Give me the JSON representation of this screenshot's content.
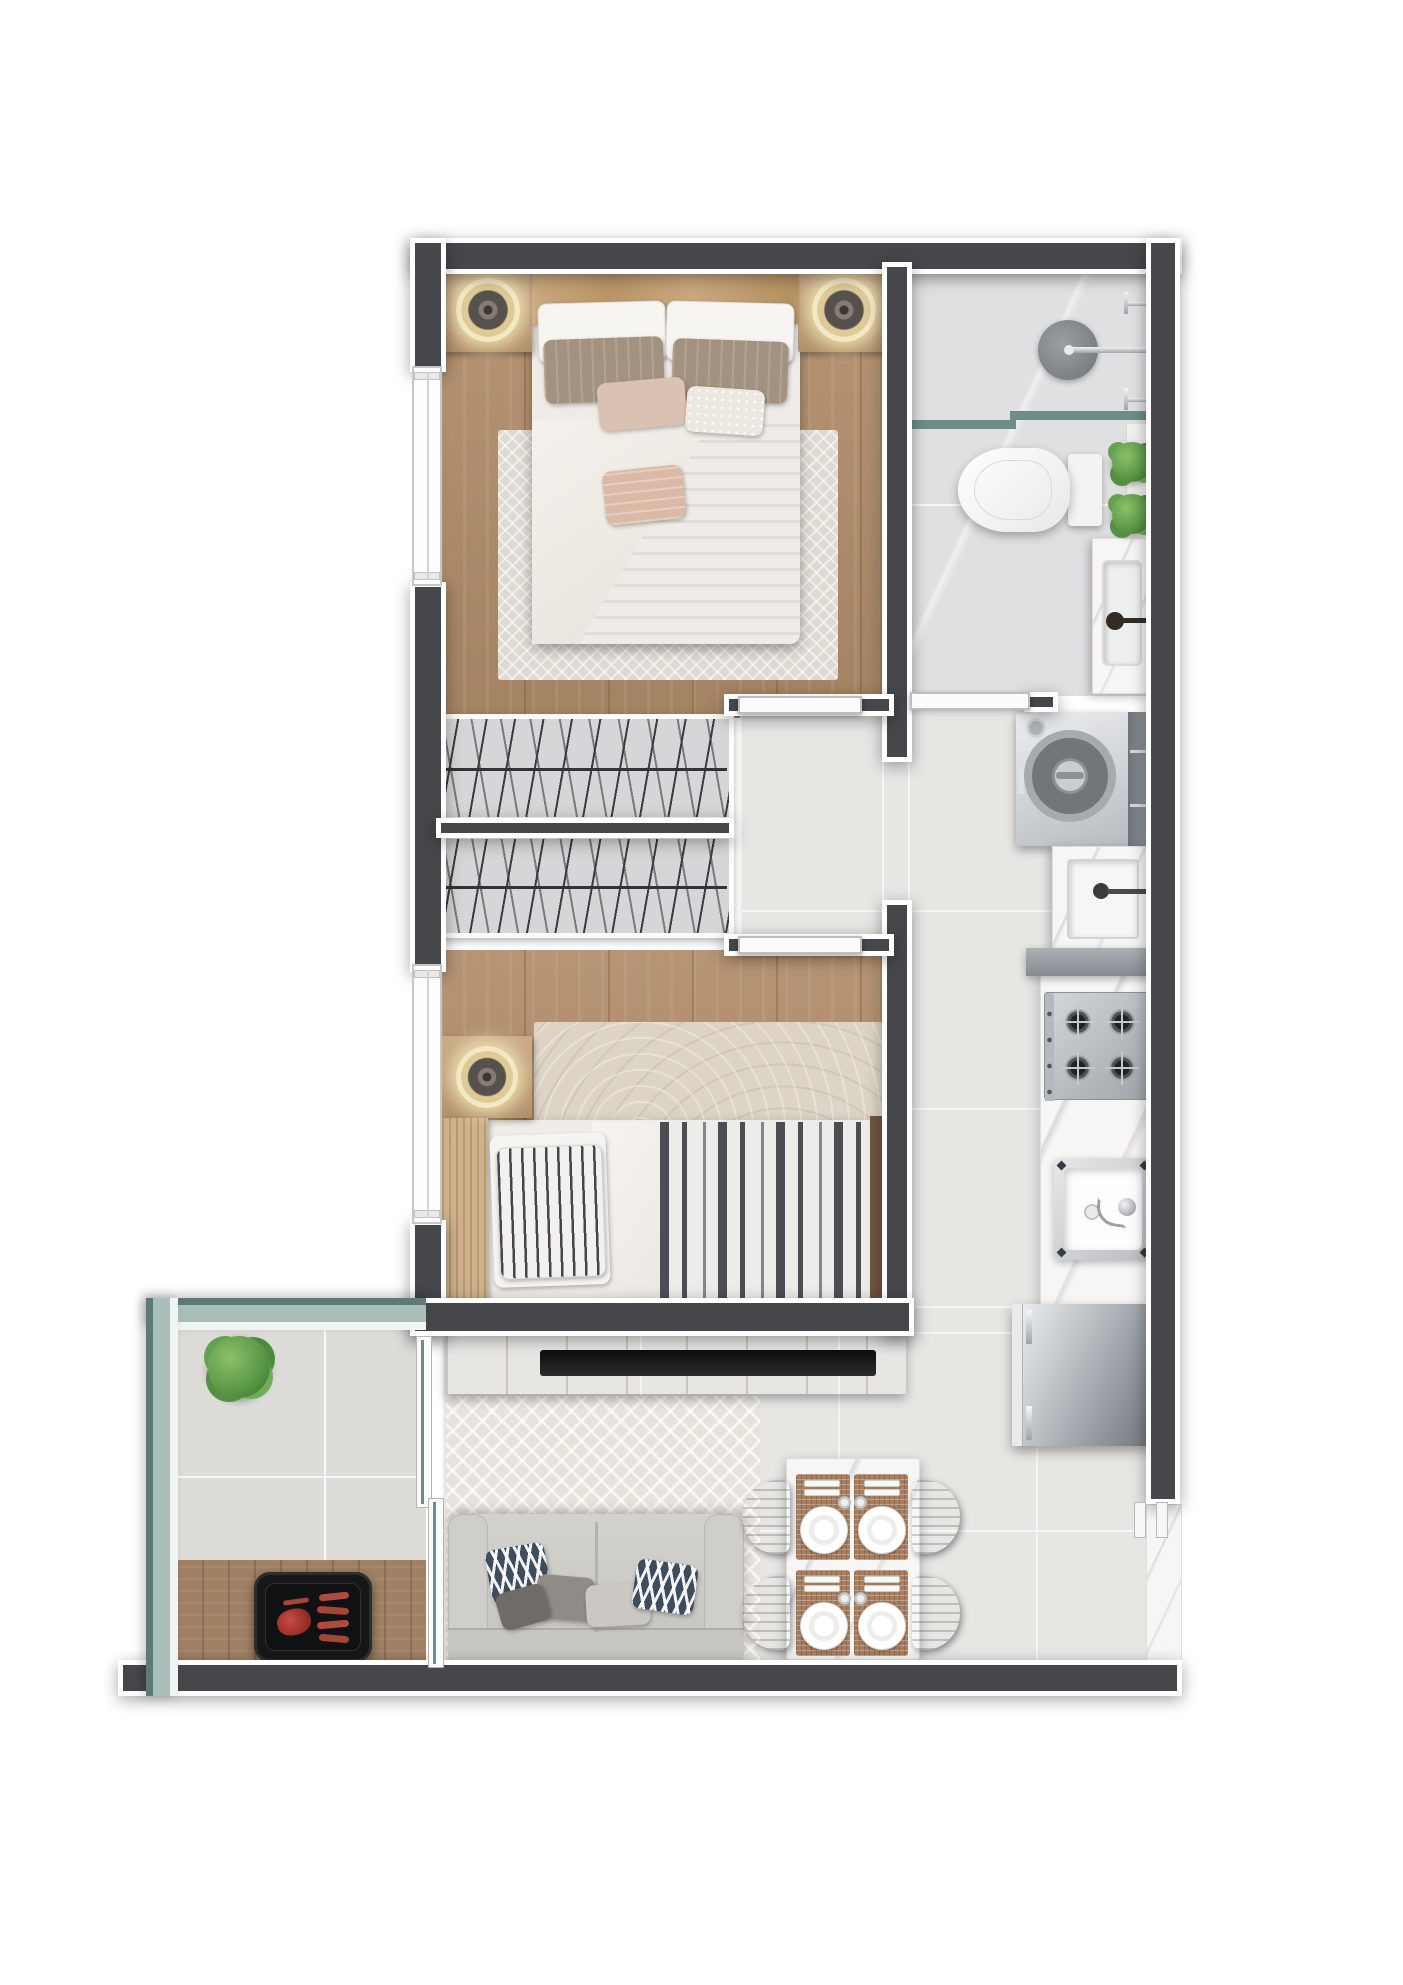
{
  "floorplan": {
    "type": "apartment-top-view-render",
    "colors": {
      "wall": "#46474a",
      "trim": "#ffffff",
      "wood_floor": "#b28e6c",
      "wood_light": "#c9a87e",
      "tile": "#e7e6e3",
      "tile_grout": "#f5f5f4",
      "bath_tile": "#e0e0e2",
      "balcony_tile": "#dedcd9",
      "teal_glass": "#6b8e8a",
      "railing_fill": "#a9c0ba",
      "railing_edge": "#5e7a74",
      "hatch": "#d4d6d7",
      "navy": "#3e4c5d",
      "deck": "#a08164"
    },
    "rooms": [
      {
        "label": "Bedroom 1",
        "floor": "wood",
        "furniture": [
          "double-bed",
          "white-pillows",
          "taupe-pillows",
          "accent-pillows",
          "duvet",
          "white-throw",
          "nightstand-left",
          "wall-lamp-left",
          "nightstand-right",
          "wall-lamp-right",
          "area-rug",
          "window"
        ]
      },
      {
        "label": "Bathroom",
        "floor": "marble-tile",
        "fixtures": [
          "shower-head",
          "shower-valves",
          "glass-screen",
          "toilet",
          "vanity-counter",
          "basin",
          "dark-faucet",
          "two-plants",
          "door"
        ]
      },
      {
        "label": "Wardrobe",
        "floor": "cabinet",
        "furniture": [
          "hanger-rail-1",
          "hanger-rail-2"
        ]
      },
      {
        "label": "Hall",
        "floor": "tile",
        "furniture": [
          "bedroom-doors"
        ]
      },
      {
        "label": "Bedroom 2",
        "floor": "wood",
        "furniture": [
          "single-bed",
          "striped-pillow",
          "striped-duvet",
          "headboard",
          "nightstand",
          "wall-lamp",
          "beige-rug",
          "window"
        ]
      },
      {
        "label": "Laundry",
        "floor": "tile",
        "fixtures": [
          "top-load-washer",
          "washer-lid",
          "laundry-tub",
          "tub-faucet",
          "half-wall"
        ]
      },
      {
        "label": "Kitchen",
        "floor": "tile",
        "fixtures": [
          "marble-counter",
          "gas-cooktop-4-burners",
          "kitchen-sink",
          "sink-faucet",
          "refrigerator"
        ]
      },
      {
        "label": "Living Room",
        "floor": "tile",
        "furniture": [
          "tv-console",
          "tv",
          "zigzag-rug",
          "two-seat-sofa",
          "chevron-pillow",
          "gray-pillow",
          "light-pillow",
          "chevron-pillow-2",
          "dark-pillow"
        ]
      },
      {
        "label": "Dining Area",
        "floor": "tile",
        "furniture": [
          "marble-table",
          "four-place-settings",
          "four-plates",
          "cutlery",
          "glasses",
          "four-wood-chairs"
        ]
      },
      {
        "label": "Balcony",
        "floor": "tile-and-deck",
        "furniture": [
          "potted-plant",
          "barbecue-grill",
          "meat",
          "sausages",
          "glass-railing",
          "sliding-door"
        ]
      },
      {
        "label": "Entrance",
        "floor": "marble-threshold",
        "fixtures": [
          "door-jambs"
        ]
      }
    ],
    "counts": {
      "bedrooms": 2,
      "bathrooms": 1,
      "windows": 2,
      "balconies": 1,
      "dining_seats": 4
    }
  }
}
